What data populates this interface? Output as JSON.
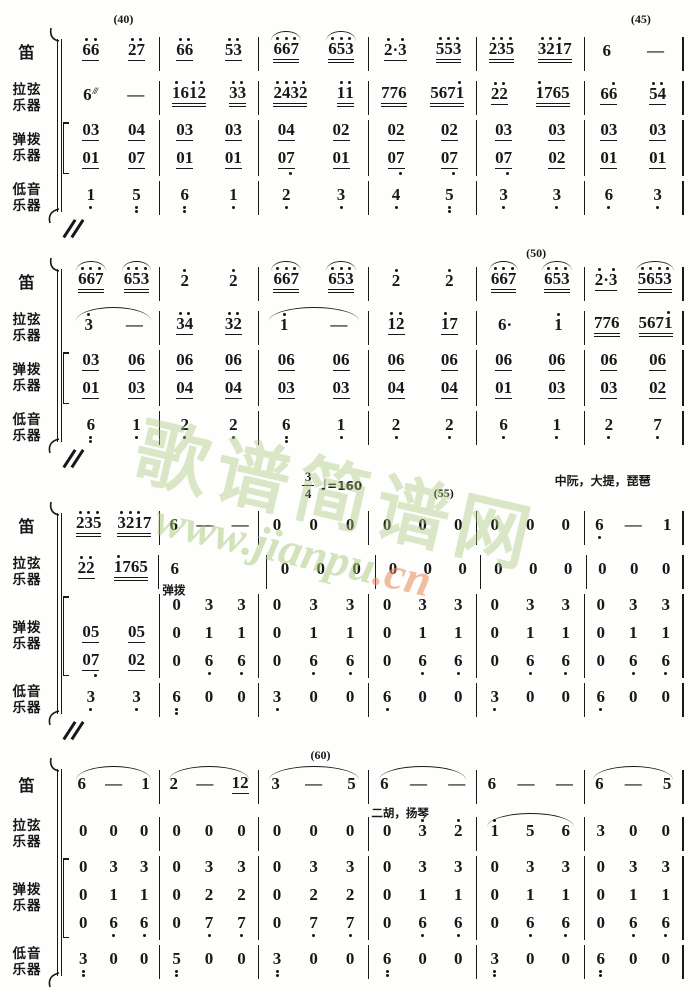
{
  "page": {
    "background": "#fefefc",
    "ink": "#181818"
  },
  "watermark": {
    "text": "歌谱简谱网",
    "url_green": "www.jianpu",
    "url_orange": ".cn",
    "green": "#a8c97e",
    "orange": "#e88c5e"
  },
  "tempo": {
    "time_sig_top": "3",
    "time_sig_bottom": "4",
    "note_glyph": "♩",
    "bpm_label": "=160"
  },
  "systems": [
    {
      "marks": [
        {
          "text": "(40)",
          "x": 9
        },
        {
          "text": "(45)",
          "x": 93
        }
      ],
      "labels": [
        {
          "lines": [
            "笛"
          ],
          "rows": 1
        },
        {
          "lines": [
            "拉弦",
            "乐器"
          ],
          "rows": 1
        },
        {
          "lines": [
            "弹拨",
            "乐器"
          ],
          "rows": 2
        },
        {
          "lines": [
            "低音",
            "乐器"
          ],
          "rows": 1
        }
      ],
      "bracket": [
        2,
        3
      ],
      "rows": [
        {
          "type": "melody",
          "cells": [
            [
              "6'6'|u1",
              "2'7'|u1"
            ],
            [
              "6'6'|u1",
              "5'3'|u1"
            ],
            [
              "6'6'7'|u2|a",
              "6'5'3'|u2|a"
            ],
            [
              "2'·3'|u1",
              "5'5'3'|u2"
            ],
            [
              "2'3'5'|u2",
              "3'2'1'7|u2"
            ],
            [
              "6",
              "—"
            ]
          ]
        },
        {
          "type": "melody",
          "cells": [
            [
              "6|tr",
              "—"
            ],
            [
              "1'61'2'|u2",
              "3'3'|u2"
            ],
            [
              "2'4'3'2'|u2",
              "1'1'|u2"
            ],
            [
              "776|u2",
              "5671'|u2"
            ],
            [
              "2'2'|u1",
              "1'765|u2"
            ],
            [
              "66'|u1",
              "5'4'|u1"
            ]
          ]
        },
        {
          "type": "pluck",
          "cells": [
            [
              "03|u1",
              "04|u1"
            ],
            [
              "03|u1",
              "03|u1"
            ],
            [
              "04|u1",
              "02|u1"
            ],
            [
              "02|u1",
              "02|u1"
            ],
            [
              "03|u1",
              "03|u1"
            ],
            [
              "03|u1",
              "03|u1"
            ]
          ]
        },
        {
          "type": "pluck",
          "cells": [
            [
              "01|u1",
              "07|u1"
            ],
            [
              "01|u1",
              "01|u1"
            ],
            [
              "07,|u1",
              "01|u1"
            ],
            [
              "07,|u1",
              "07,|u1"
            ],
            [
              "07,|u1",
              "02|u1"
            ],
            [
              "01|u1",
              "01|u1"
            ]
          ]
        },
        {
          "type": "bass",
          "cells": [
            [
              "1,",
              "5,,"
            ],
            [
              "6,,",
              "1,"
            ],
            [
              "2,",
              "3,"
            ],
            [
              "4,",
              "5,,"
            ],
            [
              "3,",
              "3,"
            ],
            [
              "6,",
              "3,"
            ]
          ]
        }
      ]
    },
    {
      "marks": [
        {
          "text": "(50)",
          "x": 76
        }
      ],
      "labels": [
        {
          "lines": [
            "笛"
          ],
          "rows": 1
        },
        {
          "lines": [
            "拉弦",
            "乐器"
          ],
          "rows": 1
        },
        {
          "lines": [
            "弹拨",
            "乐器"
          ],
          "rows": 2
        },
        {
          "lines": [
            "低音",
            "乐器"
          ],
          "rows": 1
        }
      ],
      "bracket": [
        2,
        3
      ],
      "rows": [
        {
          "type": "melody",
          "cells": [
            [
              "6'6'7'|u2|a",
              "6'5'3'|u2|a"
            ],
            [
              "2'",
              "2'"
            ],
            [
              "6'6'7'|u2|a",
              "6'5'3'|u2|a"
            ],
            [
              "2'",
              "2'"
            ],
            [
              "6'6'7'|u2|a",
              "6'5'3'|u2|a"
            ],
            [
              "2'·3'|u1",
              "5'6'5'3'|u2|a"
            ]
          ]
        },
        {
          "type": "melody",
          "cells": [
            {
              "n": [
                "3'",
                "—"
              ],
              "arc": true
            },
            [
              "3'4'|u1",
              "3'2'|u1"
            ],
            {
              "n": [
                "1'",
                "—"
              ],
              "arc": true
            },
            [
              "1'2'|u1",
              "1'7|u1"
            ],
            [
              "6·",
              "1'"
            ],
            [
              "776|u2",
              "5671'|u2"
            ]
          ]
        },
        {
          "type": "pluck",
          "cells": [
            [
              "03|u1",
              "06|u1"
            ],
            [
              "06|u1",
              "06|u1"
            ],
            [
              "06|u1",
              "06|u1"
            ],
            [
              "06|u1",
              "06|u1"
            ],
            [
              "06|u1",
              "06|u1"
            ],
            [
              "06|u1",
              "06|u1"
            ]
          ]
        },
        {
          "type": "pluck",
          "cells": [
            [
              "01|u1",
              "03|u1"
            ],
            [
              "04|u1",
              "04|u1"
            ],
            [
              "03|u1",
              "03|u1"
            ],
            [
              "04|u1",
              "04|u1"
            ],
            [
              "01|u1",
              "03|u1"
            ],
            [
              "03|u1",
              "02|u1"
            ]
          ]
        },
        {
          "type": "bass",
          "cells": [
            [
              "6,,",
              "1,"
            ],
            [
              "2,",
              "2,"
            ],
            [
              "6,,",
              "1,"
            ],
            [
              "2,",
              "2,"
            ],
            [
              "6,",
              "1,"
            ],
            [
              "2,",
              "7,"
            ]
          ]
        }
      ]
    },
    {
      "marks": [
        {
          "text": "(55)",
          "x": 61
        },
        {
          "text": "中阮，大提，琵琶",
          "x": 79,
          "cjk": true
        }
      ],
      "timesig_x": 38,
      "labels": [
        {
          "lines": [
            "笛"
          ],
          "rows": 1
        },
        {
          "lines": [
            "拉弦",
            "乐器"
          ],
          "rows": 1
        },
        {
          "lines": [
            "弹拨",
            "乐器"
          ],
          "rows": 3
        },
        {
          "lines": [
            "低音",
            "乐器"
          ],
          "rows": 1
        }
      ],
      "bracket": [
        2,
        4
      ],
      "rows": [
        {
          "type": "melody",
          "cells": [
            [
              "2'3'5'|u2",
              "3'2'1'7|u2"
            ],
            [
              "6",
              "—",
              "—"
            ],
            [
              "0",
              "0",
              "0"
            ],
            [
              "0",
              "0",
              "0"
            ],
            [
              "0",
              "0",
              "0"
            ],
            [
              "6,",
              "—",
              "1"
            ]
          ]
        },
        {
          "type": "melody",
          "cells": [
            [
              "2'2'|u1",
              "1'765|u2"
            ],
            {
              "n": [
                "6"
              ],
              "align": "left"
            },
            [
              "0",
              "0",
              "0"
            ],
            [
              "0",
              "0",
              "0"
            ],
            [
              "0",
              "0",
              "0"
            ],
            [
              "0",
              "0",
              "0"
            ]
          ]
        },
        {
          "type": "pluck",
          "cells": [
            [],
            {
              "n": [
                "0",
                "3",
                "3"
              ],
              "note": "弹拨"
            },
            [
              "0",
              "3",
              "3"
            ],
            [
              "0",
              "3",
              "3"
            ],
            [
              "0",
              "3",
              "3"
            ],
            [
              "0",
              "3",
              "3"
            ]
          ]
        },
        {
          "type": "pluck",
          "cells": [
            [
              "05|u1",
              "05|u1"
            ],
            [
              "0",
              "1",
              "1"
            ],
            [
              "0",
              "1",
              "1"
            ],
            [
              "0",
              "1",
              "1"
            ],
            [
              "0",
              "1",
              "1"
            ],
            [
              "0",
              "1",
              "1"
            ]
          ]
        },
        {
          "type": "pluck",
          "cells": [
            [
              "07,|u1",
              "02|u1"
            ],
            [
              "0",
              "6,",
              "6,"
            ],
            [
              "0",
              "6,",
              "6,"
            ],
            [
              "0",
              "6,",
              "6,"
            ],
            [
              "0",
              "6,",
              "6,"
            ],
            [
              "0",
              "6,",
              "6,"
            ]
          ]
        },
        {
          "type": "bass",
          "cells": [
            [
              "3,",
              "3,"
            ],
            [
              "6,,",
              "0",
              "0"
            ],
            [
              "3,",
              "0",
              "0"
            ],
            [
              "6,",
              "0",
              "0"
            ],
            [
              "3,",
              "0",
              "0"
            ],
            [
              "6,",
              "0",
              "0"
            ]
          ]
        }
      ]
    },
    {
      "marks": [
        {
          "text": "(60)",
          "x": 41
        }
      ],
      "labels": [
        {
          "lines": [
            "笛"
          ],
          "rows": 1
        },
        {
          "lines": [
            "拉弦",
            "乐器"
          ],
          "rows": 1
        },
        {
          "lines": [
            "弹拨",
            "乐器"
          ],
          "rows": 3
        },
        {
          "lines": [
            "低音",
            "乐器"
          ],
          "rows": 1
        }
      ],
      "bracket": [
        2,
        4
      ],
      "rows": [
        {
          "type": "melody",
          "cells": [
            {
              "n": [
                "6",
                "—",
                "1"
              ],
              "arc": true
            },
            {
              "n": [
                "2",
                "—",
                "12|u1"
              ],
              "arc": true
            },
            {
              "n": [
                "3",
                "—",
                "5"
              ],
              "arc": true
            },
            {
              "n": [
                "6",
                "—",
                "—"
              ],
              "arc": true
            },
            [
              "6",
              "—",
              "—"
            ],
            {
              "n": [
                "6",
                "—",
                "5"
              ],
              "arc": true
            }
          ]
        },
        {
          "type": "melody",
          "cells": [
            [
              "0",
              "0",
              "0"
            ],
            [
              "0",
              "0",
              "0"
            ],
            [
              "0",
              "0",
              "0"
            ],
            {
              "n": [
                "0",
                "3'",
                "2'"
              ],
              "note": "二胡，扬琴"
            },
            {
              "n": [
                "1'",
                "5",
                "6"
              ],
              "arc": true
            },
            [
              "3",
              "0",
              "0"
            ]
          ]
        },
        {
          "type": "pluck",
          "cells": [
            [
              "0",
              "3",
              "3"
            ],
            [
              "0",
              "3",
              "3"
            ],
            [
              "0",
              "3",
              "3"
            ],
            [
              "0",
              "3",
              "3"
            ],
            [
              "0",
              "3",
              "3"
            ],
            [
              "0",
              "3",
              "3"
            ]
          ]
        },
        {
          "type": "pluck",
          "cells": [
            [
              "0",
              "1",
              "1"
            ],
            [
              "0",
              "2",
              "2"
            ],
            [
              "0",
              "2",
              "2"
            ],
            [
              "0",
              "1",
              "1"
            ],
            [
              "0",
              "1",
              "1"
            ],
            [
              "0",
              "1",
              "1"
            ]
          ]
        },
        {
          "type": "pluck",
          "cells": [
            [
              "0",
              "6,",
              "6,"
            ],
            [
              "0",
              "7,",
              "7,"
            ],
            [
              "0",
              "7,",
              "7,"
            ],
            [
              "0",
              "6,",
              "6,"
            ],
            [
              "0",
              "6,",
              "6,"
            ],
            [
              "0",
              "6,",
              "6,"
            ]
          ]
        },
        {
          "type": "bass",
          "cells": [
            [
              "3,,",
              "0",
              "0"
            ],
            [
              "5,,",
              "0",
              "0"
            ],
            [
              "3,,",
              "0",
              "0"
            ],
            [
              "6,,",
              "0",
              "0"
            ],
            [
              "3,,",
              "0",
              "0"
            ],
            [
              "6,,",
              "0",
              "0"
            ]
          ]
        }
      ]
    }
  ]
}
